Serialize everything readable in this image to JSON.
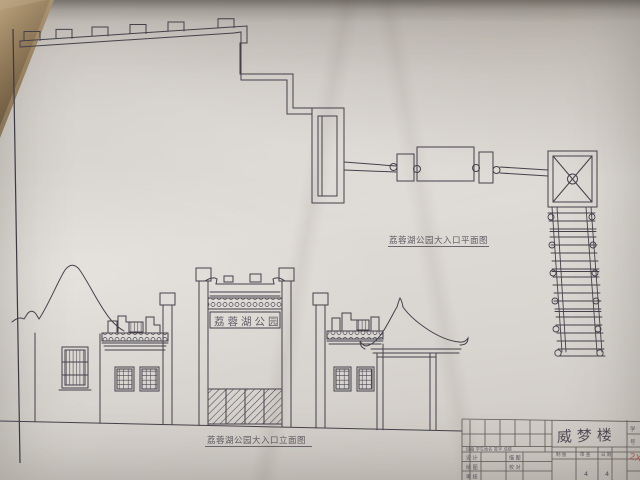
{
  "drawing": {
    "gate_sign": "荔蓉湖公园",
    "plan_title": "荔蓉湖公园大入口平面图",
    "elevation_title": "荔蓉湖公园大入口立面图"
  },
  "title_block": {
    "project_name": "威梦楼",
    "header_row": "班级 学生姓名 签字 成绩",
    "rows": [
      "设 计",
      "绘 图",
      "审 核"
    ],
    "mid_rows": [
      "描 图",
      "校 对"
    ],
    "sub_row": [
      "制 图",
      "审 查",
      "日 期"
    ],
    "bottom_marks": [
      "4",
      "4"
    ],
    "side_chars": [
      "学",
      "号"
    ],
    "red_mark": "2X"
  },
  "colors": {
    "paper": "#d8d4cf",
    "ink": "#44414b",
    "table_line": "#5b5651",
    "red_mark": "#a84a38",
    "desk": "#96805f"
  }
}
